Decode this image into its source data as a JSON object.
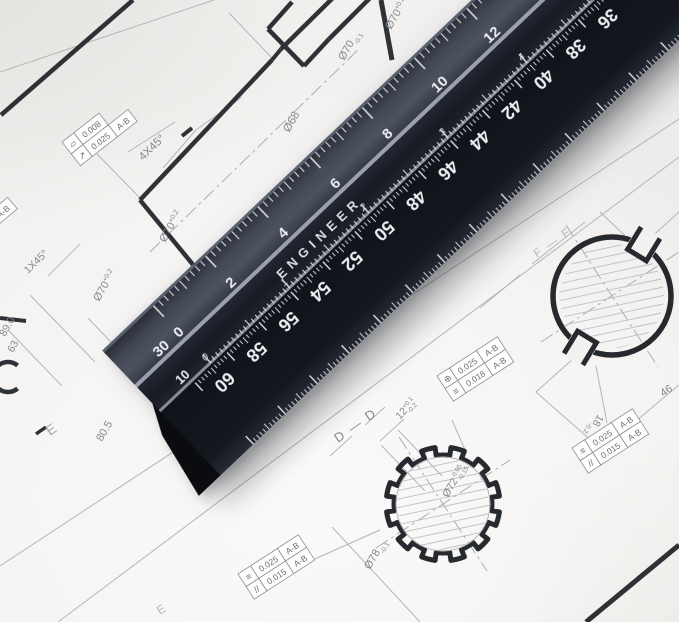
{
  "scene": {
    "type": "photograph",
    "subject": "Black triangular engineer scale ruler lying diagonally across mechanical engineering drawings"
  },
  "palette": {
    "paper": "#f2f1ef",
    "line_thick": "#2e3136",
    "line_thin": "#b3b6ba",
    "annotation_text": "#84898e",
    "ruler_top_face": "#454b57",
    "ruler_ridge": "#1d2029",
    "ruler_bottom_face": "#14171d",
    "ruler_markings": "#e9ebf0"
  },
  "ruler": {
    "brand": "ENGINEER",
    "scales": {
      "top": {
        "label": "30",
        "numbers": [
          "0",
          "2",
          "4",
          "6",
          "8",
          "10",
          "12"
        ]
      },
      "middle": {
        "label": "10",
        "numbers": [
          "0",
          "1",
          "2",
          "3",
          "4"
        ]
      },
      "bottom": {
        "numbers": [
          "60",
          "58",
          "56",
          "54",
          "52",
          "50",
          "48",
          "46",
          "44",
          "42",
          "40",
          "38",
          "36"
        ]
      }
    }
  },
  "drawing": {
    "section_labels": [
      {
        "id": "dd",
        "text": "D — D"
      },
      {
        "id": "ff",
        "text": "F — F"
      },
      {
        "id": "e1",
        "text": "E"
      },
      {
        "id": "e2",
        "text": "E"
      }
    ],
    "dimensions": [
      {
        "id": "d68",
        "text": "Ø68"
      },
      {
        "id": "d70a",
        "text": "Ø70",
        "sup": "+0.2"
      },
      {
        "id": "d70b",
        "text": "Ø70",
        "sup": "+0.2"
      },
      {
        "id": "d70c",
        "text": "Ø70",
        "sub": "-0.1"
      },
      {
        "id": "d70d",
        "text": "Ø70",
        "sup": "+0.2"
      },
      {
        "id": "d805",
        "text": "80.5"
      },
      {
        "id": "d63",
        "text": "63"
      },
      {
        "id": "d890",
        "text": "89.0"
      },
      {
        "id": "d78",
        "text": "Ø78",
        "sub": "-0.1"
      },
      {
        "id": "d72",
        "text": "Ø72",
        "sup": "-0.05",
        "sub": "-0.15"
      },
      {
        "id": "d12",
        "text": "12",
        "sup": "+0.1",
        "sub": "-0.2"
      },
      {
        "id": "d18",
        "text": "18",
        "sub": "-0.2"
      },
      {
        "id": "d46",
        "text": "46"
      },
      {
        "id": "d40",
        "text": "40"
      },
      {
        "id": "d4905",
        "text": "490.5"
      },
      {
        "id": "d770",
        "text": "770"
      },
      {
        "id": "d79",
        "text": "79"
      },
      {
        "id": "c4x45",
        "text": "4X45°"
      },
      {
        "id": "c1x45",
        "text": "1X45°"
      }
    ],
    "feature_control_frames": [
      {
        "id": "fcf1",
        "rows": [
          [
            {
              "symbol": "flatness"
            },
            {
              "value": "0.008"
            }
          ],
          [
            {
              "symbol": "circular-runout"
            },
            {
              "value": "0.025"
            },
            {
              "datum": "A-B"
            }
          ]
        ]
      },
      {
        "id": "fcf_tl",
        "rows": [
          [
            {
              "value": "0.025"
            },
            {
              "datum": "A-B"
            }
          ]
        ]
      },
      {
        "id": "fcf_top",
        "rows": [
          [
            {
              "symbol": "circular-runout"
            },
            {
              "value": "0.008"
            }
          ]
        ]
      },
      {
        "id": "fcf2",
        "rows": [
          [
            {
              "symbol": "position"
            },
            {
              "value": "0.025"
            },
            {
              "datum": "A-B"
            }
          ],
          [
            {
              "symbol": "symmetry"
            },
            {
              "value": "0.018"
            },
            {
              "datum": "A-B"
            }
          ]
        ]
      },
      {
        "id": "fcf3",
        "rows": [
          [
            {
              "symbol": "symmetry"
            },
            {
              "value": "0.025"
            },
            {
              "datum": "A-B"
            }
          ],
          [
            {
              "symbol": "parallelism"
            },
            {
              "value": "0.015"
            },
            {
              "datum": "A-B"
            }
          ]
        ]
      },
      {
        "id": "fcf4",
        "rows": [
          [
            {
              "symbol": "symmetry"
            },
            {
              "value": "0.025"
            },
            {
              "datum": "A-B"
            }
          ],
          [
            {
              "symbol": "parallelism"
            },
            {
              "value": "0.015"
            },
            {
              "datum": "A-B"
            }
          ]
        ]
      }
    ]
  }
}
